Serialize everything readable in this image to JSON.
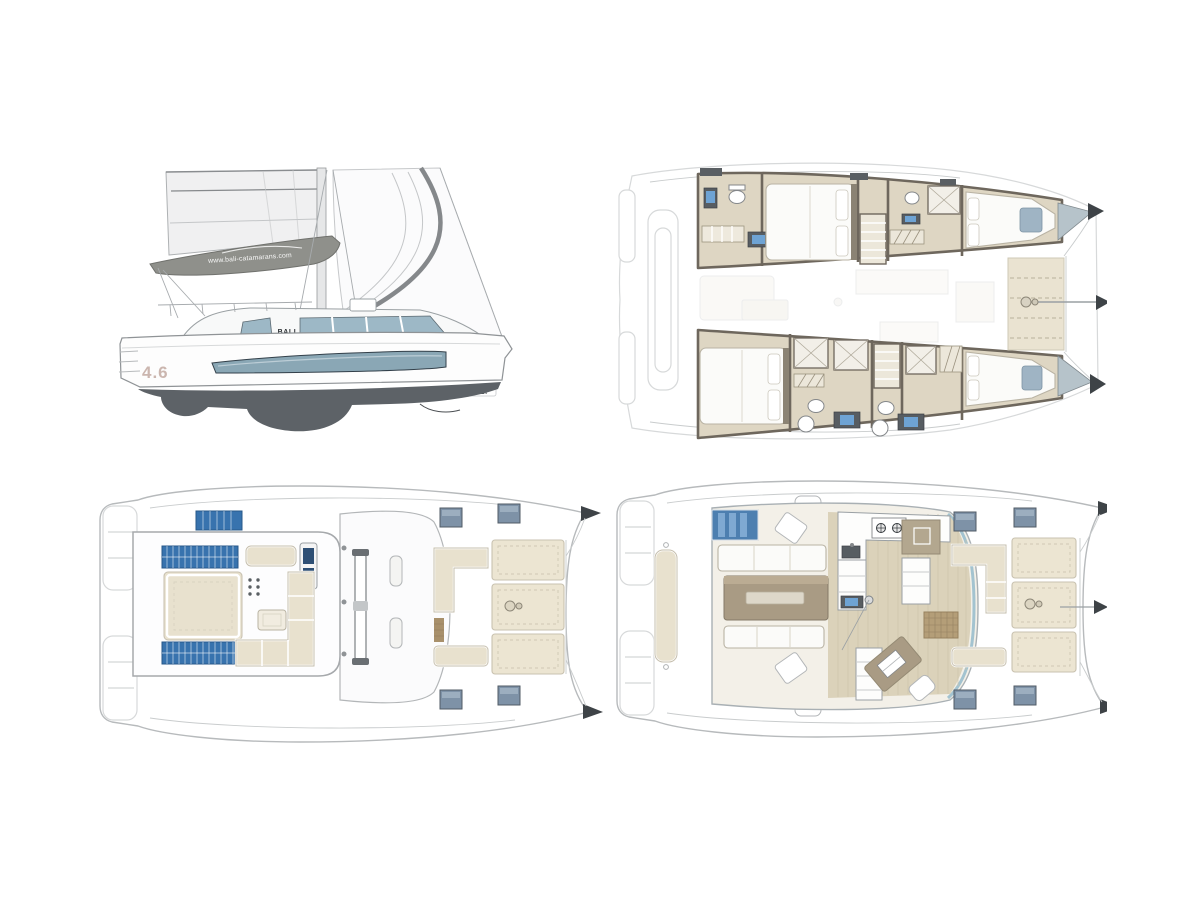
{
  "page": {
    "background_color": "#ffffff",
    "sheet_type": "catamaran-layout-sheet"
  },
  "side_view": {
    "boom_website_text": "www.bali-catamarans.com",
    "cabin_logo_text": "BALI",
    "hull_model_text": "4.6",
    "stern_logo_text": "BALI"
  },
  "palette": {
    "page_bg": "#ffffff",
    "sail": "#f0f0f1",
    "sail_edge": "#85888b",
    "boom_cover": "#8f908b",
    "hull_white": "#fdfdfd",
    "hull_underwater": "#5d6267",
    "window_glass": "#8aa7b5",
    "cabin_glass": "#9db8c6",
    "outline_gray": "#9aa0a4",
    "ghost": "#d7d9da",
    "wall": "#6e675d",
    "cabin_floor": "#ded6c3",
    "wood_floor": "#dbd2ba",
    "bed_white": "#fbfbf9",
    "cushion": "#e8e1ce",
    "sunpad": "#ece5d2",
    "solar_blue": "#3873ae",
    "hatch_blue": "#7e92a7",
    "table_taupe": "#a99b84",
    "mat_brown": "#b49e78",
    "screen_blue": "#6ea3d4",
    "skylight_blue": "#4d7fb0",
    "trampoline": "#eae3d1",
    "headboard": "#8b8374",
    "dark_fixture": "#575d62",
    "tip_dark": "#3e4347"
  }
}
